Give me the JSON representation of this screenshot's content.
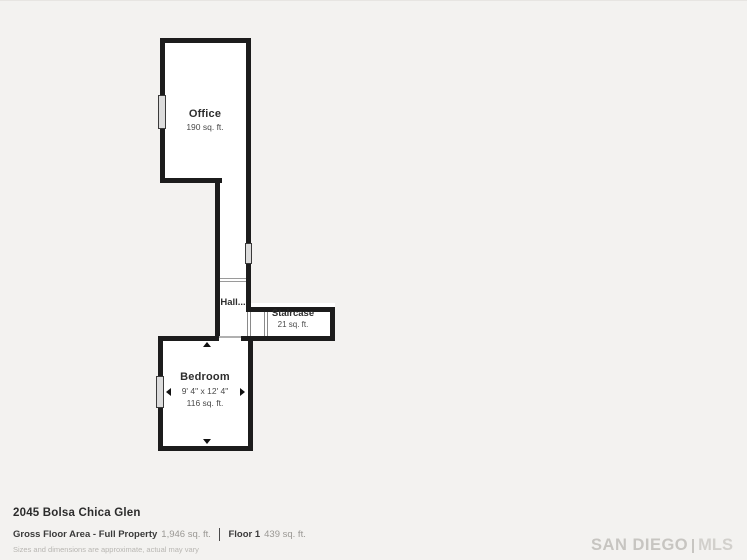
{
  "rooms": {
    "office": {
      "name": "Office",
      "area": "190 sq. ft."
    },
    "hall": {
      "name": "Hall..."
    },
    "staircase": {
      "name": "Staircase",
      "area": "21 sq. ft."
    },
    "bedroom": {
      "name": "Bedroom",
      "dimensions": "9' 4\" x 12' 4\"",
      "area": "116 sq. ft."
    }
  },
  "footer": {
    "address": "2045 Bolsa Chica Glen",
    "gross_floor_label": "Gross Floor Area - Full Property",
    "gross_floor_value": "1,946 sq. ft.",
    "floor_label": "Floor 1",
    "floor_value": "439 sq. ft.",
    "disclaimer": "Sizes and dimensions are approximate, actual may vary"
  },
  "branding": {
    "logo_left": "SAN DIEGO",
    "logo_right": "MLS"
  },
  "colors": {
    "background": "#f3f2f0",
    "wall": "#1c1c1c",
    "window_fill": "#dcdcdc",
    "text_dark": "#2e2e2e",
    "text_light": "#9a9894",
    "logo_gray": "#c7c5c1"
  }
}
